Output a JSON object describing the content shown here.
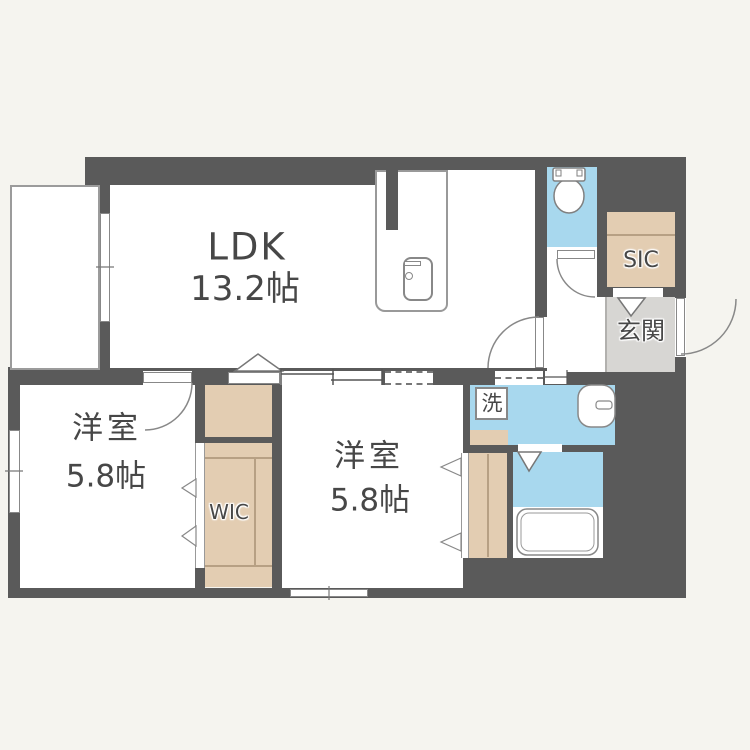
{
  "floorplan": {
    "type": "apartment-floor-plan",
    "rooms": {
      "ldk": {
        "name": "LDK",
        "size": "13.2帖"
      },
      "bedroom1": {
        "name": "洋室",
        "size": "5.8帖"
      },
      "bedroom2": {
        "name": "洋室",
        "size": "5.8帖"
      },
      "wic": {
        "label": "WIC"
      },
      "sic": {
        "label": "SIC"
      },
      "genkan": {
        "label": "玄関"
      },
      "laundry": {
        "label": "洗"
      }
    },
    "fixtures": [
      "toilet",
      "bathtub",
      "wash-basin",
      "kitchen-sink",
      "washing-machine-space",
      "balcony",
      "entrance-door",
      "sliding-door",
      "hinged-doors",
      "bifold-closet-doors"
    ],
    "colors": {
      "wall": "#5a5a5a",
      "water_area": "#a8d8ee",
      "closet": "#e3cdb2",
      "genkan_floor": "#d7d6d3",
      "floor": "#ffffff",
      "outside": "#f5f4ef",
      "fixture_line": "#888888",
      "label_text": "#474747"
    }
  }
}
